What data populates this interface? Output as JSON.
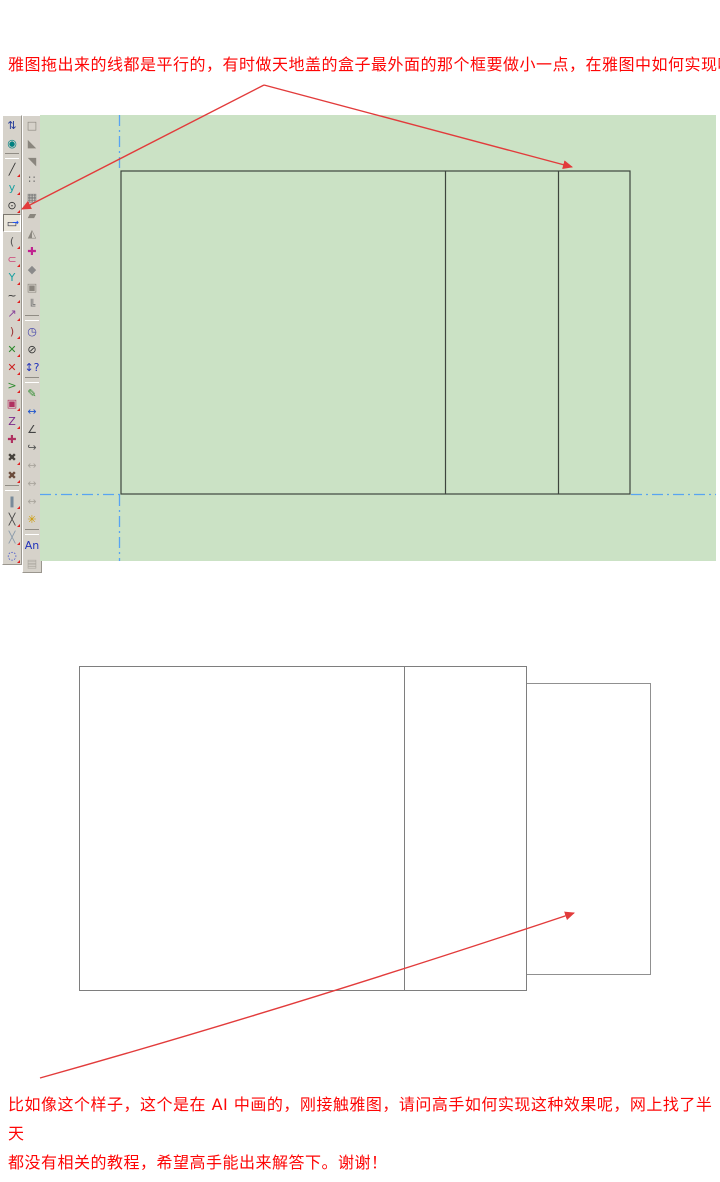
{
  "question": {
    "top_line": "雅图拖出来的线都是平行的，有时做天地盖的盒子最外面的那个框要做小一点，在雅图中如何实现呢？",
    "bottom_line1": "比如像这个样子，这个是在 AI 中画的，刚接触雅图，请问高手如何实现这种效果呢，网上找了半天",
    "bottom_line2": "都没有相关的教程，希望高手能出来解答下。谢谢！"
  },
  "colors": {
    "text_red": "#fe0606",
    "arrow_red": "#e23b3b",
    "canvas_green": "#cbe2c5",
    "cad_line": "#3e453e",
    "guide_blue": "#58a4f2",
    "toolbar_bg": "#d6d2ca",
    "ai_line": "#7e7e7e",
    "ai_line_light": "#909090"
  },
  "cad": {
    "toolbar": {
      "left": [
        {
          "name": "pan-tool-icon",
          "glyph": "⇅",
          "color": "#223a99"
        },
        {
          "name": "eye-tool-icon",
          "glyph": "◉",
          "color": "#008080"
        },
        {
          "sep": true
        },
        {
          "name": "line-tool-icon",
          "glyph": "╱",
          "color": "#333333",
          "corner": true
        },
        {
          "name": "curve-tool-icon",
          "glyph": "y",
          "color": "#1aa0a0",
          "corner": true
        },
        {
          "name": "circle-tool-icon",
          "glyph": "⊙",
          "color": "#333333",
          "corner": true
        },
        {
          "name": "rectangle-tool-icon",
          "glyph": "▭",
          "color": "#333344",
          "highlighted": true,
          "accent": "→",
          "accent_color": "#2255ee"
        },
        {
          "name": "arc-tool-icon",
          "glyph": "(",
          "color": "#555555",
          "corner": true
        },
        {
          "name": "ellipse-arc-tool-icon",
          "glyph": "⊂",
          "color": "#cc4477",
          "corner": true
        },
        {
          "name": "perpendicular-tool-icon",
          "glyph": "Y",
          "color": "#1aa0a0",
          "corner": true
        },
        {
          "name": "wave-tool-icon",
          "glyph": "~",
          "color": "#333333",
          "corner": true
        },
        {
          "name": "point-arrow-tool-icon",
          "glyph": "↗",
          "color": "#884499",
          "corner": true
        },
        {
          "name": "curve2-tool-icon",
          "glyph": ")",
          "color": "#993333",
          "corner": true
        },
        {
          "name": "cut-tool-icon",
          "glyph": "✕",
          "color": "#2e8b2e",
          "corner": true
        },
        {
          "name": "delete-tool-icon",
          "glyph": "✕",
          "color": "#cc2222",
          "corner": true
        },
        {
          "name": "chevron-tool-icon",
          "glyph": ">",
          "color": "#2e8b2e",
          "corner": true
        },
        {
          "name": "nest-rectangle-tool-icon",
          "glyph": "▣",
          "color": "#b03060",
          "corner": true
        },
        {
          "name": "zigzag-tool-icon",
          "glyph": "Z",
          "color": "#7a2a8a",
          "corner": true
        },
        {
          "name": "align-cross-tool-icon",
          "glyph": "✚",
          "color": "#b03060"
        },
        {
          "name": "search-dark-tool-icon",
          "glyph": "✖",
          "color": "#44403a",
          "corner": true
        },
        {
          "name": "search-red-tool-icon",
          "glyph": "✖",
          "color": "#6a4a3a",
          "corner": true
        },
        {
          "sep": true
        },
        {
          "name": "hatch-tool-icon",
          "glyph": "∥",
          "color": "#335577",
          "corner": true
        },
        {
          "name": "cross-points-tool-icon",
          "glyph": "╳",
          "color": "#444444",
          "corner": true
        },
        {
          "name": "hatch2-tool-icon",
          "glyph": "╳",
          "color": "#8899aa",
          "corner": true
        },
        {
          "name": "rotate-circle-tool-icon",
          "glyph": "◌",
          "color": "#3344cc",
          "corner": true
        }
      ],
      "right": [
        {
          "name": "marquee-icon",
          "glyph": "□",
          "color": "#8a867e"
        },
        {
          "name": "half-shape-a-icon",
          "glyph": "◣",
          "color": "#8a867e"
        },
        {
          "name": "half-shape-b-icon",
          "glyph": "◥",
          "color": "#8a867e"
        },
        {
          "name": "points-grid-icon",
          "glyph": "∷",
          "color": "#666666"
        },
        {
          "name": "blocks-icon",
          "glyph": "▦",
          "color": "#777777"
        },
        {
          "name": "solid-shape-icon",
          "glyph": "▰",
          "color": "#8a867e"
        },
        {
          "name": "triangle-curve-icon",
          "glyph": "◭",
          "color": "#8a867e"
        },
        {
          "name": "color-cross-icon",
          "glyph": "✚",
          "color": "#c02090"
        },
        {
          "name": "polygon-icon",
          "glyph": "◆",
          "color": "#8a8a8a"
        },
        {
          "name": "select-handles-icon",
          "glyph": "▣",
          "color": "#8a867e"
        },
        {
          "name": "stairs-icon",
          "glyph": "╚",
          "color": "#777777"
        },
        {
          "sep": true
        },
        {
          "name": "clock-icon",
          "glyph": "◷",
          "color": "#4444aa"
        },
        {
          "name": "no-entry-icon",
          "glyph": "⊘",
          "color": "#333333"
        },
        {
          "name": "updown-question-icon",
          "glyph": "↕?",
          "color": "#2233bb"
        },
        {
          "sep": true
        },
        {
          "name": "pencil-measure-icon",
          "glyph": "✎",
          "color": "#2e8b2e"
        },
        {
          "name": "horizontal-dimension-icon",
          "glyph": "↔",
          "color": "#2255cc"
        },
        {
          "name": "angle-dimension-icon",
          "glyph": "∠",
          "color": "#444444"
        },
        {
          "name": "curve-arrow-icon",
          "glyph": "↪",
          "color": "#555555"
        },
        {
          "name": "dimension-1-icon",
          "glyph": "↔",
          "color": "#aaa69e"
        },
        {
          "name": "dimension-2-icon",
          "glyph": "↔",
          "color": "#aaa69e"
        },
        {
          "name": "dimension-3-icon",
          "glyph": "↔",
          "color": "#aaa69e"
        },
        {
          "name": "star-dimension-icon",
          "glyph": "✳",
          "color": "#cc9900"
        },
        {
          "sep": true
        },
        {
          "name": "text-tool-icon",
          "glyph": "An",
          "color": "#2233bb"
        },
        {
          "name": "last-grayed-icon",
          "glyph": "▤",
          "color": "#aaa69e"
        }
      ]
    }
  }
}
